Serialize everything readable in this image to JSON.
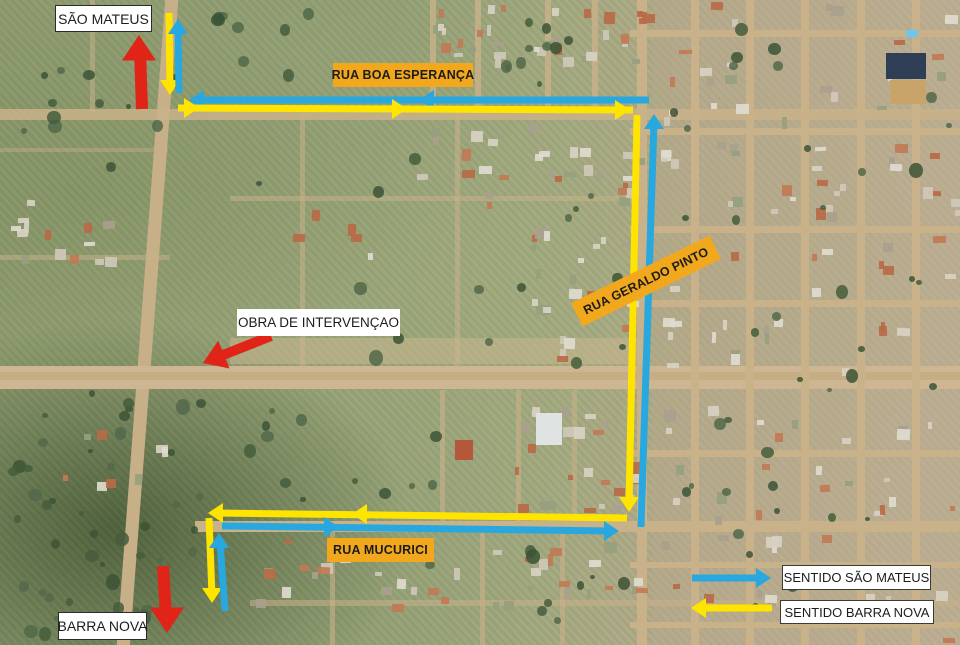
{
  "destinations": {
    "north": "SÃO MATEUS",
    "south": "BARRA NOVA"
  },
  "streets": {
    "boa_esperanca": "RUA BOA ESPERANÇA",
    "geraldo_pinto": "RUA GERALDO PINTO",
    "mucurici": "RUA MUCURICI"
  },
  "intervention": {
    "label": "OBRA DE INTERVENÇAO"
  },
  "legend": {
    "items": [
      {
        "id": "sm",
        "label": "SENTIDO SÃO MATEUS",
        "color_key": "sm",
        "direction": "right"
      },
      {
        "id": "bn",
        "label": "SENTIDO BARRA NOVA",
        "color_key": "bn",
        "direction": "left"
      }
    ]
  },
  "colors": {
    "sm": "#29a8e0",
    "bn": "#ffe400",
    "alert": "#e02417",
    "street_label_bg": "#f2a81d",
    "label_bg": "#ffffff",
    "label_text": "#1c1c1c"
  },
  "routes": {
    "segments": [
      {
        "name": "bn-north-approach",
        "color": "bn",
        "width": 7,
        "pts": [
          [
            169,
            13
          ],
          [
            170,
            88
          ]
        ],
        "heads": [
          {
            "x": 170,
            "y": 95,
            "a": 90
          }
        ]
      },
      {
        "name": "sm-north-exit",
        "color": "sm",
        "width": 7,
        "pts": [
          [
            179,
            93
          ],
          [
            178,
            27
          ]
        ],
        "heads": [
          {
            "x": 178,
            "y": 19,
            "a": -90
          }
        ]
      },
      {
        "name": "sm-boa-esperanca-west",
        "color": "sm",
        "width": 7,
        "pts": [
          [
            649,
            100
          ],
          [
            197,
            100
          ]
        ],
        "heads": [
          {
            "x": 419,
            "y": 100,
            "a": 180
          },
          {
            "x": 189,
            "y": 100,
            "a": 180
          }
        ]
      },
      {
        "name": "bn-boa-esperanca-east",
        "color": "bn",
        "width": 7,
        "pts": [
          [
            178,
            108
          ],
          [
            633,
            110
          ]
        ],
        "heads": [
          {
            "x": 199,
            "y": 108,
            "a": 0
          },
          {
            "x": 407,
            "y": 109,
            "a": 0
          },
          {
            "x": 630,
            "y": 110,
            "a": 0
          }
        ]
      },
      {
        "name": "bn-geraldo-pinto-south",
        "color": "bn",
        "width": 7,
        "pts": [
          [
            637,
            115
          ],
          [
            629,
            505
          ]
        ],
        "heads": [
          {
            "x": 629,
            "y": 512,
            "a": 90
          }
        ]
      },
      {
        "name": "sm-geraldo-pinto-north",
        "color": "sm",
        "width": 7,
        "pts": [
          [
            641,
            527
          ],
          [
            654,
            122
          ]
        ],
        "heads": [
          {
            "x": 654,
            "y": 114,
            "a": -90
          }
        ]
      },
      {
        "name": "bn-mucurici-west",
        "color": "bn",
        "width": 7,
        "pts": [
          [
            627,
            518
          ],
          [
            215,
            513
          ]
        ],
        "heads": [
          {
            "x": 352,
            "y": 514,
            "a": 180
          },
          {
            "x": 208,
            "y": 513,
            "a": 180
          }
        ]
      },
      {
        "name": "sm-mucurici-east",
        "color": "sm",
        "width": 7,
        "pts": [
          [
            222,
            526
          ],
          [
            612,
            531
          ]
        ],
        "heads": [
          {
            "x": 339,
            "y": 527,
            "a": 0
          },
          {
            "x": 619,
            "y": 531,
            "a": 0
          }
        ]
      },
      {
        "name": "bn-south-exit",
        "color": "bn",
        "width": 7,
        "pts": [
          [
            209,
            518
          ],
          [
            212,
            596
          ]
        ],
        "heads": [
          {
            "x": 212,
            "y": 603,
            "a": 90
          }
        ]
      },
      {
        "name": "sm-south-approach",
        "color": "sm",
        "width": 7,
        "pts": [
          [
            225,
            611
          ],
          [
            220,
            541
          ]
        ],
        "heads": [
          {
            "x": 219,
            "y": 533,
            "a": -90
          }
        ]
      },
      {
        "name": "alert-arrow-sao-mateus",
        "color": "alert",
        "width": 12,
        "pts": [
          [
            142,
            109
          ],
          [
            140,
            50
          ]
        ],
        "heads": [
          {
            "x": 139,
            "y": 35,
            "a": -90,
            "s": 1.7
          }
        ]
      },
      {
        "name": "alert-arrow-obra",
        "color": "alert",
        "width": 10,
        "pts": [
          [
            271,
            336
          ],
          [
            218,
            357
          ]
        ],
        "heads": [
          {
            "x": 203,
            "y": 363,
            "a": 158,
            "s": 1.5
          }
        ]
      },
      {
        "name": "alert-arrow-barra-nova",
        "color": "alert",
        "width": 12,
        "pts": [
          [
            163,
            566
          ],
          [
            166,
            617
          ]
        ],
        "heads": [
          {
            "x": 167,
            "y": 633,
            "a": 90,
            "s": 1.7
          }
        ]
      },
      {
        "name": "legend-sm-arrow",
        "color": "sm",
        "width": 7,
        "pts": [
          [
            692,
            578
          ],
          [
            763,
            578
          ]
        ],
        "heads": [
          {
            "x": 771,
            "y": 578,
            "a": 0
          }
        ]
      },
      {
        "name": "legend-bn-arrow",
        "color": "bn",
        "width": 7,
        "pts": [
          [
            772,
            608
          ],
          [
            699,
            608
          ]
        ],
        "heads": [
          {
            "x": 691,
            "y": 608,
            "a": 180
          }
        ]
      }
    ]
  }
}
